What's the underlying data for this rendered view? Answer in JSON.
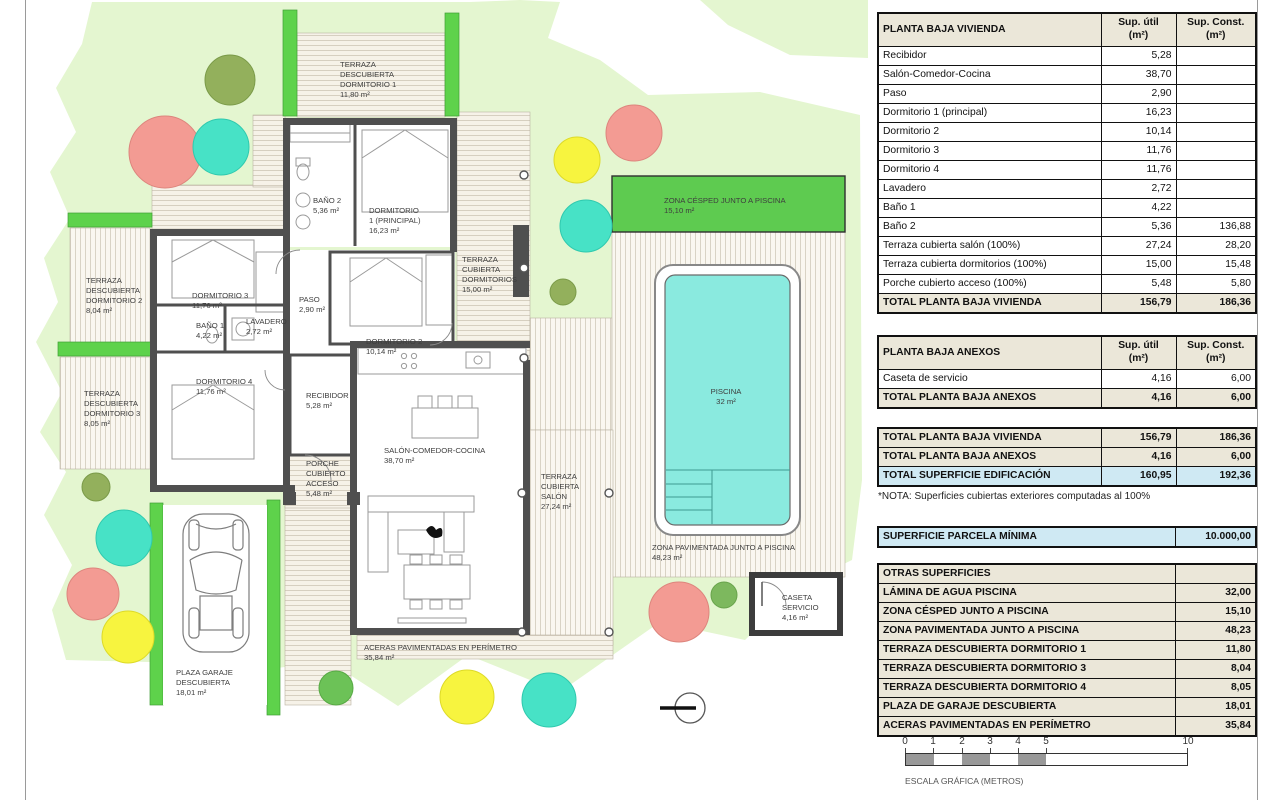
{
  "plan": {
    "labels": [
      {
        "text": "TERRAZA\nDESCUBIERTA\nDORMITORIO 1\n11,80 m²"
      },
      {
        "text": "BAÑO 2\n5,36 m²"
      },
      {
        "text": "DORMITORIO\n1 (PRINCIPAL)\n16,23 m²"
      },
      {
        "text": "TERRAZA\nCUBIERTA\nDORMITORIOS\n15,00 m²"
      },
      {
        "text": "ZONA CÉSPED JUNTO A PISCINA\n15,10 m²"
      },
      {
        "text": "TERRAZA\nDESCUBIERTA\nDORMITORIO 2\n8,04 m²"
      },
      {
        "text": "DORMITORIO 3\n11,76 m²"
      },
      {
        "text": "PASO\n2,90 m²"
      },
      {
        "text": "BAÑO 1\n4,22 m²"
      },
      {
        "text": "LAVADERO\n2,72 m²"
      },
      {
        "text": "DORMITORIO 2\n10,14 m²"
      },
      {
        "text": "TERRAZA\nDESCUBIERTA\nDORMITORIO 3\n8,05 m²"
      },
      {
        "text": "DORMITORIO 4\n11,76 m²"
      },
      {
        "text": "RECIBIDOR\n5,28 m²"
      },
      {
        "text": "PISCINA\n32 m²"
      },
      {
        "text": "PORCHE\nCUBIERTO\nACCESO\n5,48 m²"
      },
      {
        "text": "SALÓN-COMEDOR-COCINA\n38,70 m²"
      },
      {
        "text": "TERRAZA\nCUBIERTA\nSALÓN\n27,24 m²"
      },
      {
        "text": "ZONA PAVIMENTADA JUNTO A PISCINA\n48,23 m²"
      },
      {
        "text": "CASETA\nSERVICIO\n4,16 m²"
      },
      {
        "text": "ACERAS PAVIMENTADAS EN PERÍMETRO\n35,84 m²"
      },
      {
        "text": "PLAZA GARAJE\nDESCUBIERTA\n18,01 m²"
      }
    ],
    "colors": {
      "lawn": "#e4f6d0",
      "planter": "#5ed24b",
      "cesped_zone": "#5ecb50",
      "pool_water": "#8aeadf",
      "wall": "#4f4f4f",
      "tree_salmon": "#f39b93",
      "tree_turquoise": "#47e2c6",
      "tree_yellow": "#f7f43f",
      "tree_olive": "#93b05c",
      "tree_green": "#6cc257"
    }
  },
  "tables": {
    "vivienda": {
      "title": "PLANTA BAJA VIVIENDA",
      "col_util": "Sup. útil\n(m²)",
      "col_const": "Sup. Const.\n(m²)",
      "rows": [
        {
          "n": "Recibidor",
          "u": "5,28",
          "c": ""
        },
        {
          "n": "Salón-Comedor-Cocina",
          "u": "38,70",
          "c": ""
        },
        {
          "n": "Paso",
          "u": "2,90",
          "c": ""
        },
        {
          "n": "Dormitorio 1 (principal)",
          "u": "16,23",
          "c": ""
        },
        {
          "n": "Dormitorio 2",
          "u": "10,14",
          "c": ""
        },
        {
          "n": "Dormitorio 3",
          "u": "11,76",
          "c": ""
        },
        {
          "n": "Dormitorio 4",
          "u": "11,76",
          "c": ""
        },
        {
          "n": "Lavadero",
          "u": "2,72",
          "c": ""
        },
        {
          "n": "Baño 1",
          "u": "4,22",
          "c": ""
        },
        {
          "n": "Baño 2",
          "u": "5,36",
          "c": "136,88"
        },
        {
          "n": "Terraza cubierta salón (100%)",
          "u": "27,24",
          "c": "28,20"
        },
        {
          "n": "Terraza cubierta dormitorios (100%)",
          "u": "15,00",
          "c": "15,48"
        },
        {
          "n": "Porche cubierto acceso (100%)",
          "u": "5,48",
          "c": "5,80"
        }
      ],
      "total": {
        "n": "TOTAL PLANTA BAJA VIVIENDA",
        "u": "156,79",
        "c": "186,36"
      }
    },
    "anexos": {
      "title": "PLANTA BAJA ANEXOS",
      "col_util": "Sup. útil\n(m²)",
      "col_const": "Sup. Const.\n(m²)",
      "rows": [
        {
          "n": "Caseta de servicio",
          "u": "4,16",
          "c": "6,00"
        }
      ],
      "total": {
        "n": "TOTAL PLANTA BAJA ANEXOS",
        "u": "4,16",
        "c": "6,00"
      }
    },
    "resumen": {
      "rows": [
        {
          "n": "TOTAL PLANTA BAJA VIVIENDA",
          "u": "156,79",
          "c": "186,36"
        },
        {
          "n": "TOTAL PLANTA BAJA ANEXOS",
          "u": "4,16",
          "c": "6,00"
        },
        {
          "n": "TOTAL SUPERFICIE EDIFICACIÓN",
          "u": "160,95",
          "c": "192,36"
        }
      ],
      "nota": "*NOTA: Superficies cubiertas exteriores computadas al 100%"
    },
    "parcela": {
      "label": "SUPERFICIE PARCELA MÍNIMA",
      "value": "10.000,00"
    },
    "otras": {
      "title": "OTRAS SUPERFICIES",
      "rows": [
        {
          "n": "LÁMINA DE AGUA PISCINA",
          "v": "32,00"
        },
        {
          "n": "ZONA CÉSPED JUNTO A PISCINA",
          "v": "15,10"
        },
        {
          "n": "ZONA PAVIMENTADA JUNTO A PISCINA",
          "v": "48,23"
        },
        {
          "n": "TERRAZA DESCUBIERTA DORMITORIO 1",
          "v": "11,80"
        },
        {
          "n": "TERRAZA DESCUBIERTA DORMITORIO 3",
          "v": "8,04"
        },
        {
          "n": "TERRAZA DESCUBIERTA DORMITORIO 4",
          "v": "8,05"
        },
        {
          "n": "PLAZA DE GARAJE DESCUBIERTA",
          "v": "18,01"
        },
        {
          "n": "ACERAS PAVIMENTADAS EN PERÍMETRO",
          "v": "35,84"
        }
      ]
    }
  },
  "scalebar": {
    "ticks": [
      "0",
      "1",
      "2",
      "3",
      "4",
      "5",
      "10"
    ],
    "caption": "ESCALA GRÁFICA (METROS)"
  }
}
